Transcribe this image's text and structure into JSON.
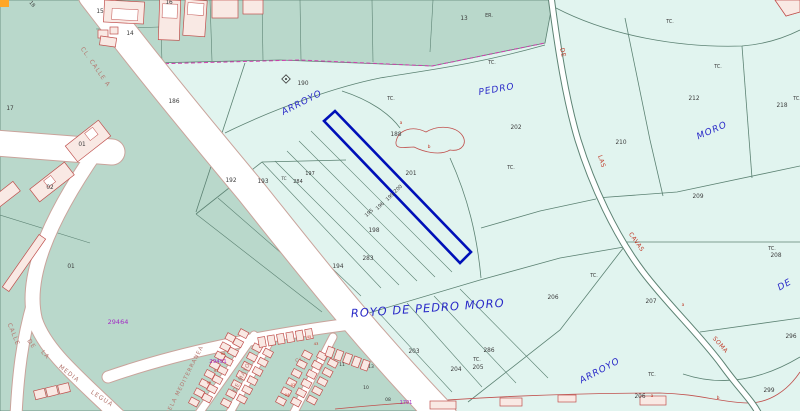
{
  "map": {
    "type": "cadastral-parcel-map",
    "selected_parcel": "200",
    "colors": {
      "rural": "#e1f4ef",
      "urban": "#b9d8cb",
      "roadfill": "#ffffff",
      "boundary": "#5c8273",
      "urbancase": "#c9a39b",
      "bfill": "#f9e9e4",
      "bstroke": "#c0504d",
      "highlight": "#0010b8",
      "magenta": "#cf3fae",
      "blue": "#2929c8",
      "red": "#c03a28",
      "street": "#b4776f",
      "purple": "#a32cc4",
      "dark": "#3a3a3a",
      "orange": "#ffa726"
    },
    "labels": [
      {
        "t": "ARROYO",
        "x": 303,
        "y": 105,
        "r": -27,
        "s": 9,
        "k": "top"
      },
      {
        "t": "PEDRO",
        "x": 497,
        "y": 92,
        "r": -10,
        "s": 9,
        "k": "top"
      },
      {
        "t": "MORO",
        "x": 713,
        "y": 133,
        "r": -24,
        "s": 9,
        "k": "top"
      },
      {
        "t": "ROYO DE PEDRO MORO",
        "x": 428,
        "y": 312,
        "r": -4,
        "s": 11.5,
        "k": "top"
      },
      {
        "t": "ARROYO",
        "x": 601,
        "y": 373,
        "r": -28,
        "s": 9,
        "k": "top"
      },
      {
        "t": "DE",
        "x": 786,
        "y": 287,
        "r": -30,
        "s": 9,
        "k": "top"
      },
      {
        "t": "CL.  CALLE  A",
        "x": 94,
        "y": 68,
        "r": 55,
        "s": 6,
        "k": "str"
      },
      {
        "t": "CALLE",
        "x": 12,
        "y": 335,
        "r": 68,
        "s": 6,
        "k": "str"
      },
      {
        "t": "DE",
        "x": 30,
        "y": 345,
        "r": 55,
        "s": 6,
        "k": "str"
      },
      {
        "t": "LA",
        "x": 44,
        "y": 356,
        "r": 48,
        "s": 6,
        "k": "str"
      },
      {
        "t": "MEDIA",
        "x": 68,
        "y": 375,
        "r": 38,
        "s": 6,
        "k": "str"
      },
      {
        "t": "LEGUA",
        "x": 101,
        "y": 400,
        "r": 33,
        "s": 6,
        "k": "str"
      },
      {
        "t": "DELA MEDITERRANEA",
        "x": 186,
        "y": 381,
        "r": -63,
        "s": 5.5,
        "k": "str"
      },
      {
        "t": "DE MAYO",
        "x": 243,
        "y": 378,
        "r": -63,
        "s": 5.5,
        "k": "str"
      },
      {
        "t": "CL.",
        "x": 301,
        "y": 361,
        "r": -15,
        "s": 5,
        "k": "str"
      },
      {
        "t": "DE",
        "x": 561,
        "y": 53,
        "r": 78,
        "s": 6,
        "k": "rd"
      },
      {
        "t": "LAS",
        "x": 600,
        "y": 162,
        "r": 72,
        "s": 6,
        "k": "rd"
      },
      {
        "t": "CAVAS",
        "x": 635,
        "y": 243,
        "r": 55,
        "s": 6,
        "k": "rd"
      },
      {
        "t": "SOMA",
        "x": 719,
        "y": 346,
        "r": 48,
        "s": 6,
        "k": "rd"
      },
      {
        "t": "15",
        "x": 100,
        "y": 13,
        "k": "p"
      },
      {
        "t": "14",
        "x": 130,
        "y": 35,
        "k": "p"
      },
      {
        "t": "16",
        "x": 169,
        "y": 4,
        "k": "p"
      },
      {
        "t": "18",
        "x": 31,
        "y": 5,
        "r": 50,
        "s": 5,
        "k": "p"
      },
      {
        "t": "13",
        "x": 464,
        "y": 20,
        "k": "p"
      },
      {
        "t": "17",
        "x": 10,
        "y": 110,
        "k": "p"
      },
      {
        "t": "01",
        "x": 82,
        "y": 146,
        "k": "p"
      },
      {
        "t": "02",
        "x": 50,
        "y": 189,
        "k": "p"
      },
      {
        "t": "01",
        "x": 71,
        "y": 268,
        "k": "p"
      },
      {
        "t": "186",
        "x": 174,
        "y": 103,
        "k": "p"
      },
      {
        "t": "190",
        "x": 303,
        "y": 85,
        "k": "p"
      },
      {
        "t": "188",
        "x": 396,
        "y": 136,
        "k": "p"
      },
      {
        "t": "201",
        "x": 411,
        "y": 175,
        "k": "p"
      },
      {
        "t": "200",
        "x": 399,
        "y": 190,
        "r": -42,
        "s": 5,
        "k": "p"
      },
      {
        "t": "199",
        "x": 391,
        "y": 198,
        "r": -42,
        "s": 5,
        "k": "p"
      },
      {
        "t": "196",
        "x": 381,
        "y": 207,
        "r": -42,
        "s": 5,
        "k": "p"
      },
      {
        "t": "195",
        "x": 370,
        "y": 214,
        "r": -42,
        "s": 5,
        "k": "p"
      },
      {
        "t": "198",
        "x": 374,
        "y": 232,
        "k": "p"
      },
      {
        "t": "283",
        "x": 368,
        "y": 260,
        "k": "p"
      },
      {
        "t": "194",
        "x": 338,
        "y": 268,
        "k": "p"
      },
      {
        "t": "197",
        "x": 310,
        "y": 175,
        "s": 5,
        "k": "p"
      },
      {
        "t": "284",
        "x": 298,
        "y": 183,
        "s": 5,
        "k": "p"
      },
      {
        "t": "193",
        "x": 263,
        "y": 183,
        "k": "p"
      },
      {
        "t": "192",
        "x": 231,
        "y": 182,
        "k": "p"
      },
      {
        "t": "202",
        "x": 516,
        "y": 129,
        "k": "p"
      },
      {
        "t": "212",
        "x": 694,
        "y": 100,
        "k": "p"
      },
      {
        "t": "218",
        "x": 782,
        "y": 107,
        "k": "p"
      },
      {
        "t": "210",
        "x": 621,
        "y": 144,
        "k": "p"
      },
      {
        "t": "209",
        "x": 698,
        "y": 198,
        "k": "p"
      },
      {
        "t": "208",
        "x": 776,
        "y": 257,
        "k": "p"
      },
      {
        "t": "206",
        "x": 553,
        "y": 299,
        "k": "p"
      },
      {
        "t": "207",
        "x": 651,
        "y": 303,
        "k": "p"
      },
      {
        "t": "296",
        "x": 791,
        "y": 338,
        "k": "p"
      },
      {
        "t": "299",
        "x": 769,
        "y": 392,
        "k": "p"
      },
      {
        "t": "206",
        "x": 640,
        "y": 398,
        "k": "p"
      },
      {
        "t": "203",
        "x": 414,
        "y": 353,
        "k": "p"
      },
      {
        "t": "204",
        "x": 456,
        "y": 371,
        "k": "p"
      },
      {
        "t": "205",
        "x": 478,
        "y": 369,
        "k": "p"
      },
      {
        "t": "286",
        "x": 489,
        "y": 352,
        "k": "p"
      },
      {
        "t": "11",
        "x": 342,
        "y": 366,
        "s": 4.5,
        "k": "p"
      },
      {
        "t": "13",
        "x": 371,
        "y": 368,
        "s": 4.5,
        "k": "p"
      },
      {
        "t": "10",
        "x": 366,
        "y": 389,
        "s": 4.5,
        "k": "p"
      },
      {
        "t": "08",
        "x": 388,
        "y": 401,
        "s": 4.5,
        "k": "p"
      },
      {
        "t": "TC.",
        "x": 391,
        "y": 100,
        "s": 4.8,
        "k": "l"
      },
      {
        "t": "TC.",
        "x": 492,
        "y": 64,
        "s": 4.8,
        "k": "l"
      },
      {
        "t": "TC.",
        "x": 511,
        "y": 169,
        "s": 4.8,
        "k": "l"
      },
      {
        "t": "TC.",
        "x": 670,
        "y": 23,
        "s": 4.8,
        "k": "l"
      },
      {
        "t": "TC.",
        "x": 718,
        "y": 68,
        "s": 4.8,
        "k": "l"
      },
      {
        "t": "TC.",
        "x": 797,
        "y": 100,
        "s": 4.8,
        "k": "l"
      },
      {
        "t": "TC.",
        "x": 772,
        "y": 250,
        "s": 4.8,
        "k": "l"
      },
      {
        "t": "TC.",
        "x": 594,
        "y": 277,
        "s": 4.8,
        "k": "l"
      },
      {
        "t": "TC.",
        "x": 652,
        "y": 376,
        "s": 4.8,
        "k": "l"
      },
      {
        "t": "TC.",
        "x": 477,
        "y": 361,
        "s": 4.8,
        "k": "l"
      },
      {
        "t": "TC",
        "x": 284,
        "y": 180,
        "s": 4.2,
        "k": "l"
      },
      {
        "t": "ER.",
        "x": 489,
        "y": 17,
        "s": 4.8,
        "k": "l"
      },
      {
        "t": "a",
        "x": 401,
        "y": 124,
        "s": 4.5,
        "k": "a"
      },
      {
        "t": "b",
        "x": 429,
        "y": 148,
        "s": 4.5,
        "k": "a"
      },
      {
        "t": "a",
        "x": 683,
        "y": 306,
        "s": 4.5,
        "k": "a"
      },
      {
        "t": "a",
        "x": 652,
        "y": 397,
        "s": 4.5,
        "k": "a"
      },
      {
        "t": "b",
        "x": 718,
        "y": 399,
        "s": 4.5,
        "k": "a"
      },
      {
        "t": "29464",
        "x": 118,
        "y": 324,
        "s": 6.5,
        "k": "b"
      },
      {
        "t": "29491",
        "x": 218,
        "y": 363,
        "s": 5.5,
        "k": "b"
      },
      {
        "t": "1701",
        "x": 406,
        "y": 404,
        "s": 5,
        "k": "b"
      },
      {
        "t": "99",
        "x": 223,
        "y": 355,
        "s": 3.8,
        "k": "h"
      },
      {
        "t": "97",
        "x": 216,
        "y": 372,
        "s": 3.8,
        "k": "h"
      },
      {
        "t": "95",
        "x": 209,
        "y": 384,
        "s": 3.8,
        "k": "h"
      },
      {
        "t": "45",
        "x": 309,
        "y": 338,
        "s": 3.8,
        "k": "h"
      },
      {
        "t": "43",
        "x": 316,
        "y": 345,
        "s": 3.8,
        "k": "h"
      },
      {
        "t": "04",
        "x": 287,
        "y": 396,
        "s": 3.8,
        "k": "h"
      },
      {
        "t": "02",
        "x": 293,
        "y": 386,
        "s": 3.8,
        "k": "h"
      }
    ]
  }
}
